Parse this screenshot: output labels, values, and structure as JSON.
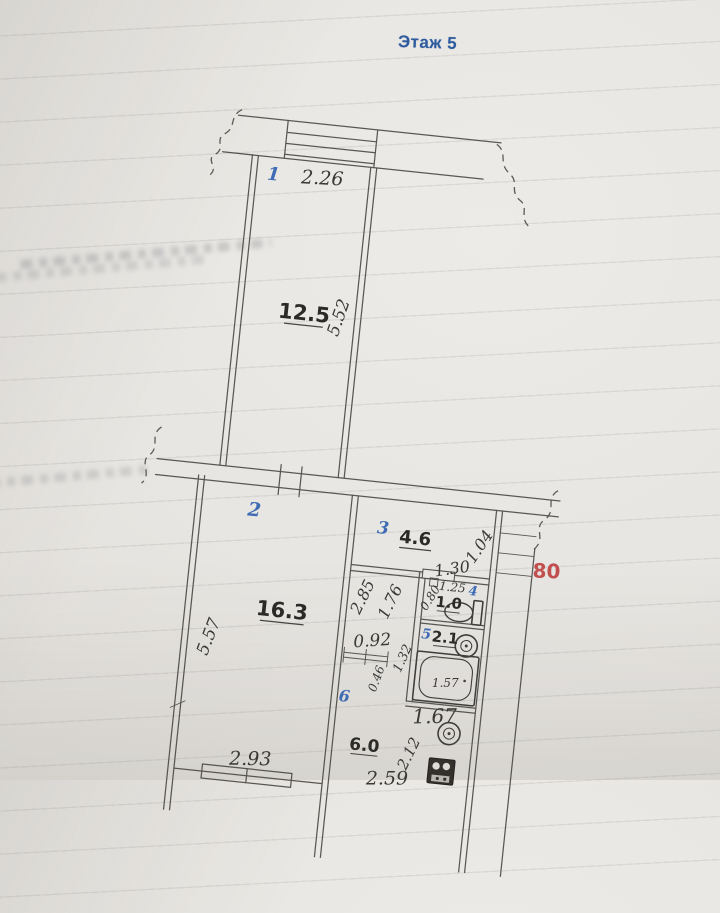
{
  "header": {
    "floor": "Этаж 5"
  },
  "shaft": {
    "width": "80"
  },
  "balcony": {
    "number": "1",
    "width": "2.26"
  },
  "upper_room": {
    "area": "12.5",
    "depth": "5.52"
  },
  "living_room": {
    "number": "2",
    "area": "16.3",
    "depth": "5.57",
    "width": "2.93"
  },
  "hall": {
    "number": "3",
    "area": "4.6",
    "d130": "1.30",
    "d104": "1.04",
    "d285": "2.85",
    "d176": "1.76",
    "d092": "0.92",
    "d046": "0.46"
  },
  "wc": {
    "number": "4",
    "area": "1.0",
    "d125": "1.25",
    "d080": "0.80"
  },
  "bath": {
    "number": "5",
    "area": "2.1",
    "d132": "1.32",
    "d157": "1.57",
    "d167": "1.67"
  },
  "kitchen": {
    "number": "6",
    "area": "6.0",
    "d212": "2.12",
    "d259": "2.59"
  },
  "colors": {
    "room_number_blue": "#3f6cb4",
    "header_blue": "#2d5b9e",
    "shaft_red": "#c14f4d",
    "ink": "#4c4b47"
  }
}
